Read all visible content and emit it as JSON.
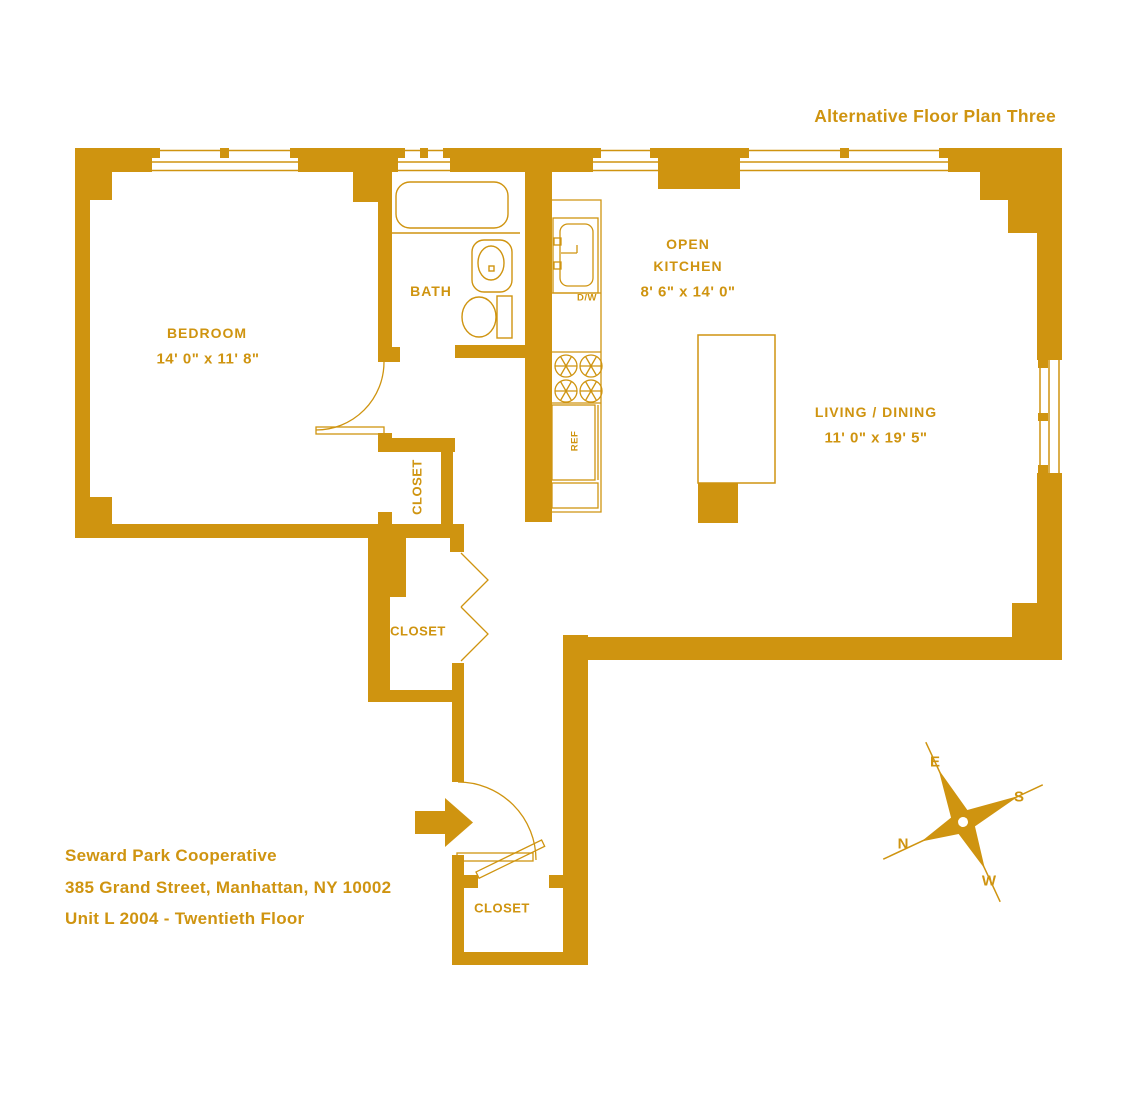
{
  "title": "Alternative Floor Plan Three",
  "colors": {
    "gold": "#CF9410",
    "background": "#FFFFFF"
  },
  "rooms": {
    "bedroom": {
      "name": "BEDROOM",
      "dims": "14' 0\" x 11' 8\""
    },
    "bath": {
      "name": "BATH"
    },
    "open_kitchen": {
      "name_line1": "OPEN",
      "name_line2": "KITCHEN",
      "dims": "8' 6\" x 14' 0\""
    },
    "living_dining": {
      "name": "LIVING / DINING",
      "dims": "11' 0\" x 19' 5\""
    },
    "closet_upper": {
      "name": "CLOSET"
    },
    "closet_lower": {
      "name": "CLOSET"
    },
    "closet_entry": {
      "name": "CLOSET"
    }
  },
  "appliances": {
    "dishwasher": "D/W",
    "refrigerator": "REF"
  },
  "compass": {
    "east": "E",
    "south": "S",
    "north": "N",
    "west": "W"
  },
  "footer": {
    "building": "Seward Park Cooperative",
    "address": "385 Grand Street, Manhattan, NY 10002",
    "unit": "Unit L 2004 - Twentieth Floor"
  }
}
